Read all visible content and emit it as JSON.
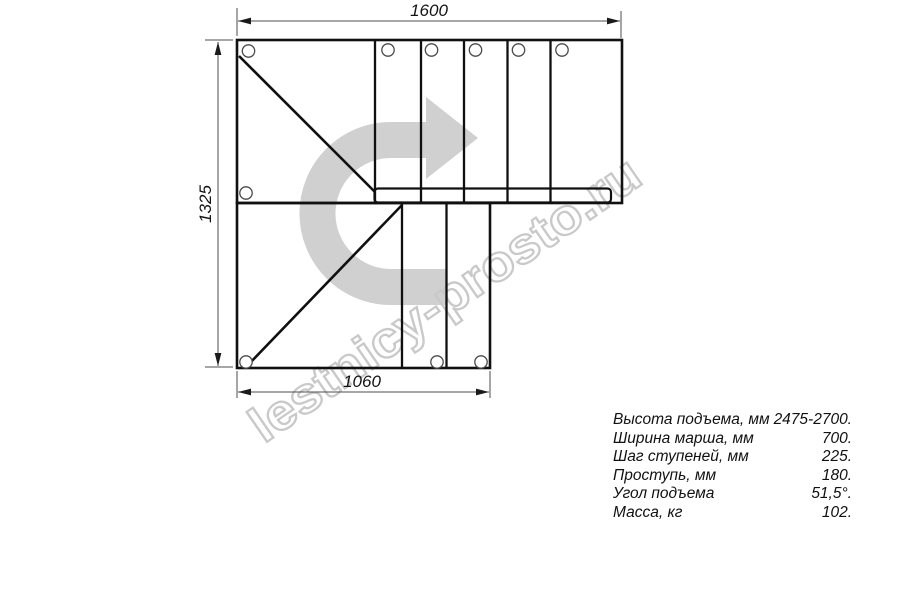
{
  "watermark": {
    "text": "lestnicy-prosto.ru"
  },
  "drawing": {
    "title": "staircase-plan-view",
    "dimensions": {
      "top": "1600",
      "left": "1325",
      "bottom": "1060"
    }
  },
  "specs": {
    "rows": [
      {
        "label": "Высота подъема, мм",
        "value": "2475-2700."
      },
      {
        "label": "Ширина марша, мм",
        "value": "700."
      },
      {
        "label": "Шаг ступеней, мм",
        "value": "225."
      },
      {
        "label": "Проступь, мм",
        "value": "180."
      },
      {
        "label": "Угол подъема",
        "value": "51,5°."
      },
      {
        "label": "Масса, кг",
        "value": "102."
      }
    ]
  },
  "colors": {
    "arrow_gray": "#d0d0d0",
    "watermark_gray": "#c9c9c9",
    "line_black": "#101010",
    "dim_gray": "#4d4d4d"
  }
}
